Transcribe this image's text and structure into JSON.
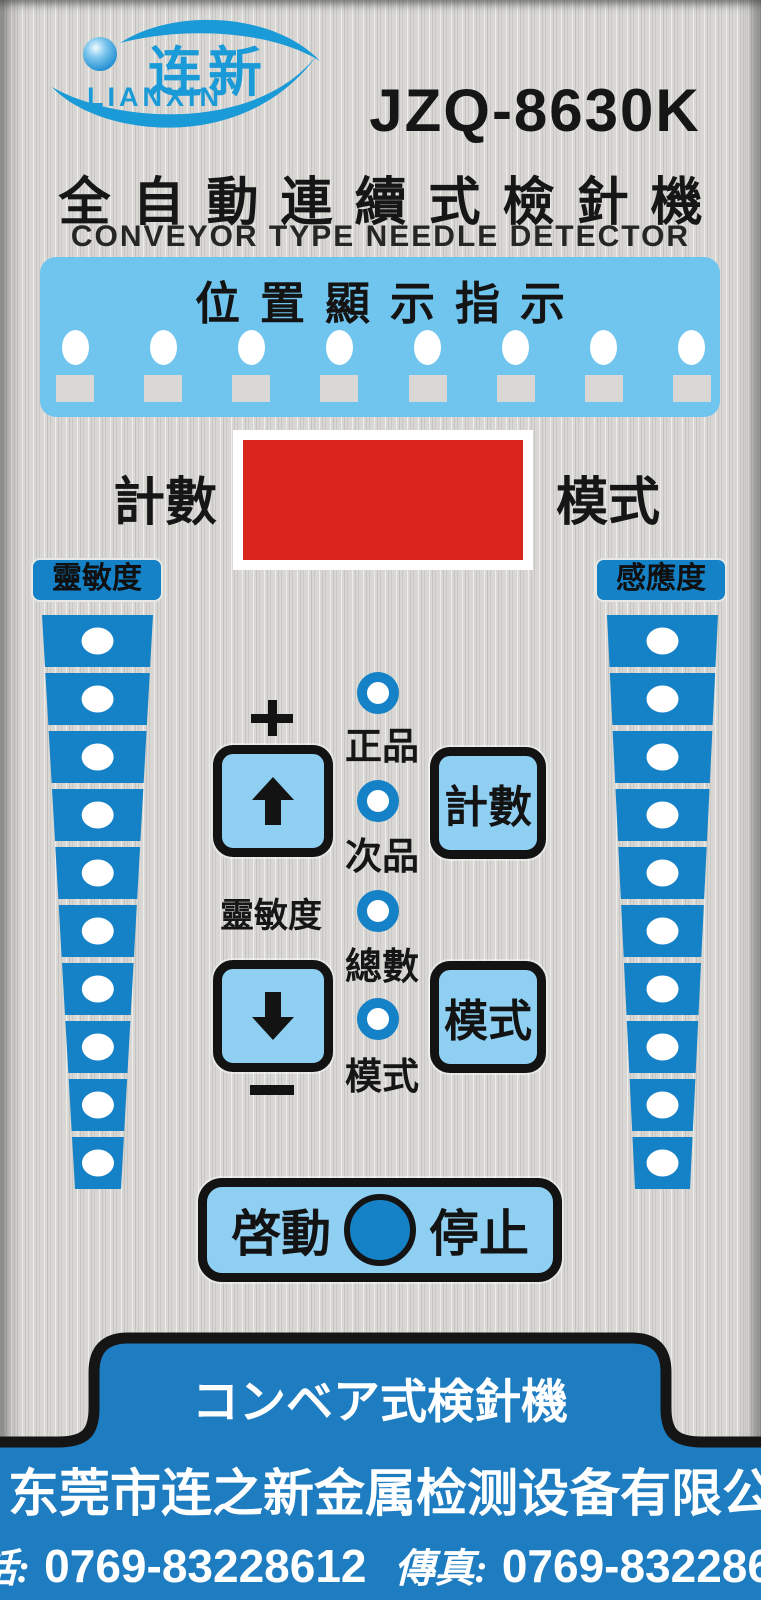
{
  "brand": {
    "logo_cn": "连新",
    "logo_en": "LIANXIN",
    "model": "JZQ-8630K"
  },
  "header": {
    "title_cn": "全自動連續式檢針機",
    "title_en": "CONVEYOR TYPE NEEDLE DETECTOR"
  },
  "position_panel": {
    "title": "位置顯示指示",
    "led_count": 8
  },
  "counter": {
    "left_label": "計數",
    "right_label": "模式"
  },
  "columns": {
    "left": {
      "label": "靈敏度",
      "segments": 10
    },
    "right": {
      "label": "感應度",
      "segments": 10
    }
  },
  "controls": {
    "center_label": "靈敏度",
    "count_button": "計數",
    "mode_button": "模式",
    "leds": [
      {
        "label": "正品"
      },
      {
        "label": "次品"
      },
      {
        "label": "總數"
      },
      {
        "label": "模式"
      }
    ]
  },
  "start_stop": {
    "start": "啓動",
    "stop": "停止"
  },
  "footer": {
    "tab": "コンベア式検針機",
    "company": "东莞市连之新金属检测设备有限公司",
    "phone_label": "電話:",
    "phone_number": "0769-83228612",
    "fax_label": "傳真:",
    "fax_number": "0769-83228650"
  },
  "colors": {
    "primary": "#1581c6",
    "panel_blue": "#70c5ee",
    "button_blue": "#8ecff2",
    "display_red": "#d9251d",
    "footer_blue": "#1e7dc1",
    "logo_blue": "#1a9ad6"
  }
}
